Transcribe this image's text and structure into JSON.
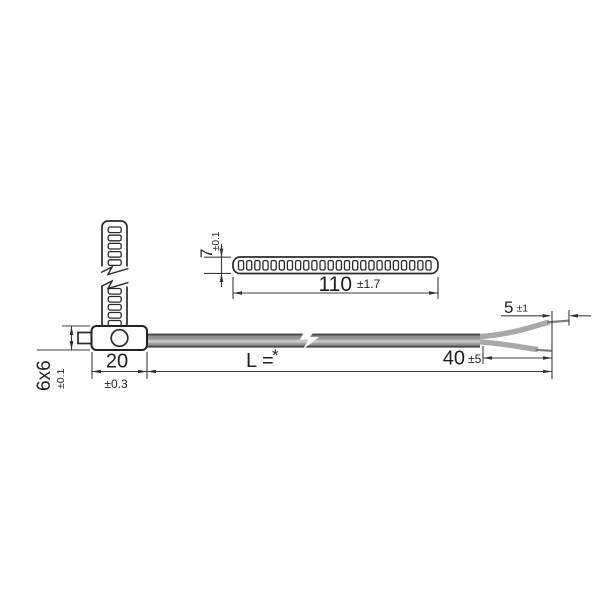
{
  "dimensions": {
    "strip_width": {
      "value": "7",
      "tolerance": "±0.1"
    },
    "strip_length": {
      "value": "110",
      "tolerance": "±1.7"
    },
    "body_section": {
      "value": "6x6",
      "tolerance": "±0.1"
    },
    "body_length": {
      "value": "20",
      "tolerance": "±0.3"
    },
    "cable_length": {
      "label": "L =",
      "asterisk": "*"
    },
    "split_length": {
      "value": "40",
      "tolerance": "±5"
    },
    "tip_length": {
      "value": "5",
      "tolerance": "±1"
    }
  },
  "perforations": {
    "strip_top_view_holes": 24,
    "strip_side_view_holes_above_break": 5,
    "strip_side_view_holes_below_break": 5
  },
  "colors": {
    "background": "#ffffff",
    "outline": "#2a2a2a",
    "dimension_line": "#3d3d3d",
    "cable_edge": "#454545",
    "cable_mid": "#9c9c9c",
    "cable_highlight": "#c8c8c8",
    "wire_insulation": "#a8a8a8",
    "wire_bare_tip": "#7d7d7d"
  }
}
